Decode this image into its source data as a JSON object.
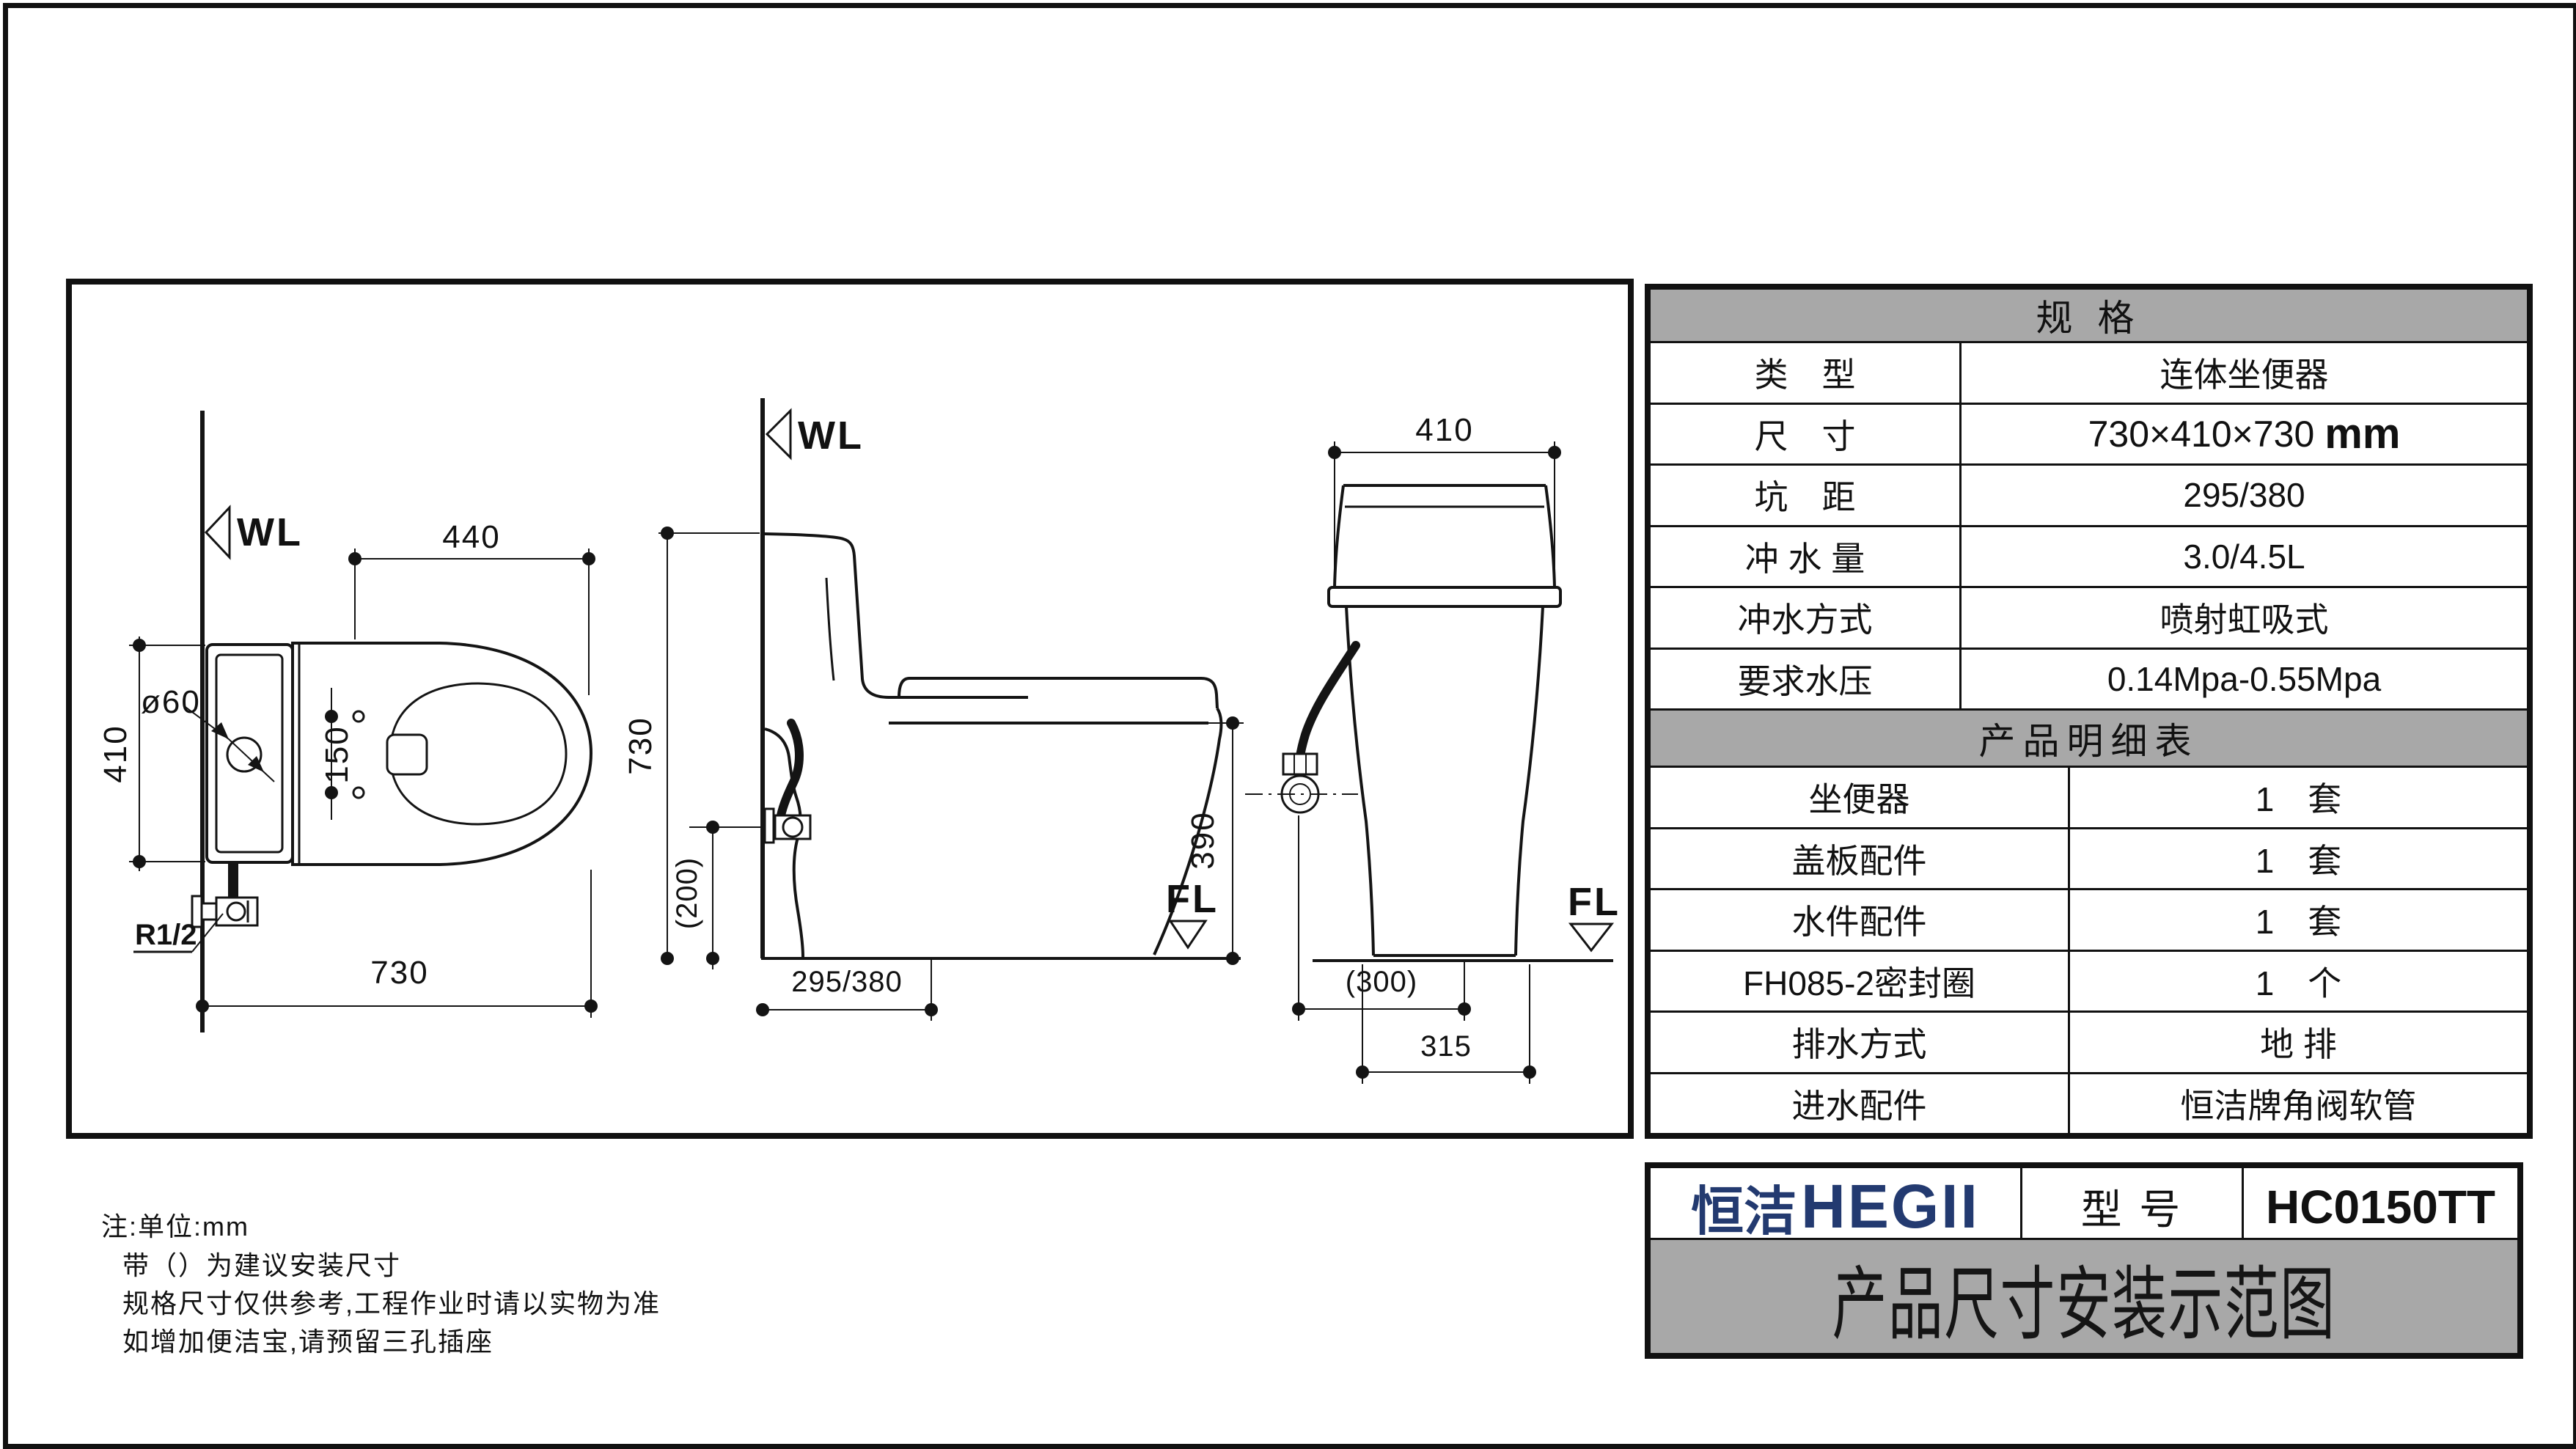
{
  "drawing": {
    "plan": {
      "wl": "WL",
      "dim_top": "440",
      "dim_hole": "ø60",
      "dim_left": "410",
      "dim_bolts": "150",
      "thread": "R1/2",
      "dim_bottom": "730"
    },
    "side": {
      "wl": "WL",
      "dim_height": "730",
      "dim_valve": "(200)",
      "dim_rim": "390",
      "dim_roughin": "295/380",
      "fl": "FL"
    },
    "front": {
      "dim_top": "410",
      "dim_hose": "(300)",
      "dim_base": "315",
      "fl": "FL"
    }
  },
  "spec_table": {
    "title": "规  格",
    "rows": [
      {
        "label": "类　型",
        "value": "连体坐便器"
      },
      {
        "label": "尺　寸",
        "value": "730×410×730",
        "unit": "mm"
      },
      {
        "label": "坑　距",
        "value": "295/380"
      },
      {
        "label": "冲 水 量",
        "value": "3.0/4.5L"
      },
      {
        "label": "冲水方式",
        "value": "喷射虹吸式"
      },
      {
        "label": "要求水压",
        "value": "0.14Mpa-0.55Mpa"
      }
    ]
  },
  "detail_table": {
    "title": "产品明细表",
    "rows": [
      {
        "label": "坐便器",
        "value": "1　套"
      },
      {
        "label": "盖板配件",
        "value": "1　套"
      },
      {
        "label": "水件配件",
        "value": "1　套"
      },
      {
        "label": "FH085-2密封圈",
        "value": "1　个"
      },
      {
        "label": "排水方式",
        "value": "地 排"
      },
      {
        "label": "进水配件",
        "value": "恒洁牌角阀软管"
      }
    ]
  },
  "title_block": {
    "brand_cn": "恒洁",
    "brand_en": "HEGII",
    "model_label": "型 号",
    "model": "HC0150TT",
    "doc_title": "产品尺寸安装示范图"
  },
  "notes": {
    "line1": "注:单位:mm",
    "line2": "带（）为建议安装尺寸",
    "line3": "规格尺寸仅供参考,工程作业时请以实物为准",
    "line4": "如增加便洁宝,请预留三孔插座"
  },
  "colors": {
    "brand_navy": "#233a70",
    "table_header_gray": "#a8a8a8",
    "line": "#141414"
  }
}
